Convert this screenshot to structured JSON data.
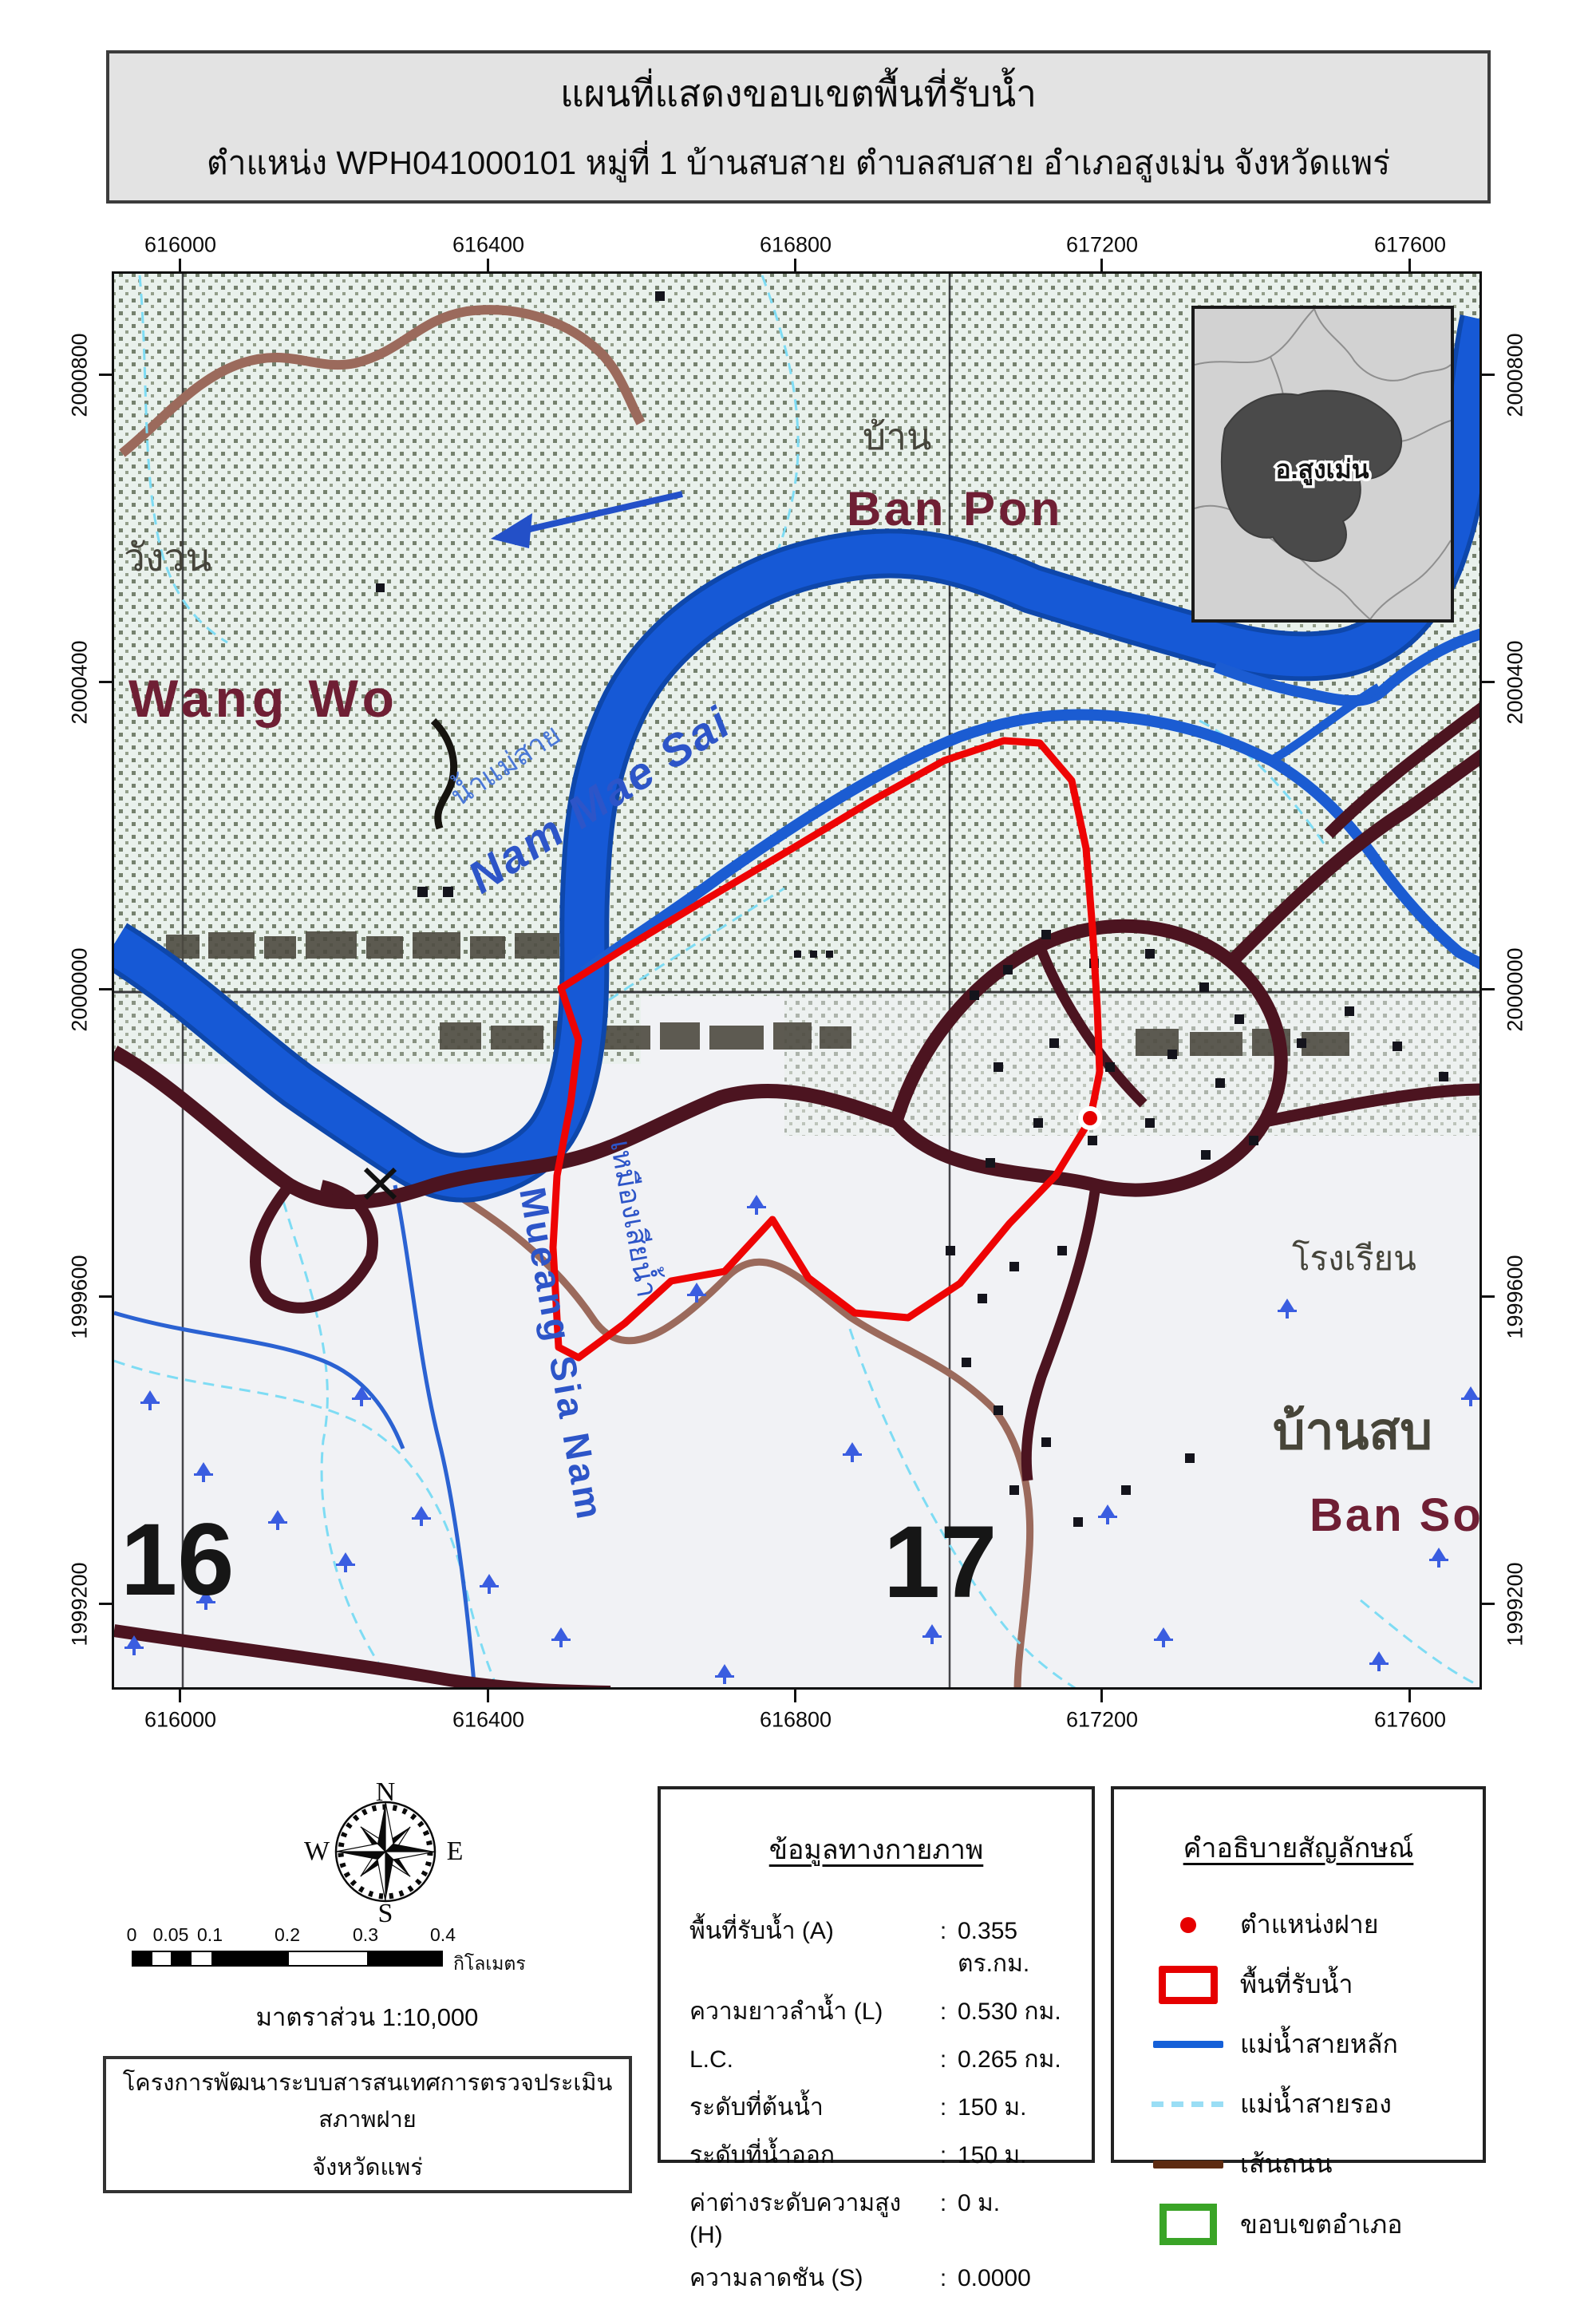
{
  "title": {
    "line1": "แผนที่แสดงขอบเขตพื้นที่รับน้ำ",
    "line2": "ตำแหน่ง WPH041000101 หมู่ที่ 1 บ้านสบสาย ตำบลสบสาย อำเภอสูงเม่น จังหวัดแพร่"
  },
  "axes": {
    "x": [
      "616000",
      "616400",
      "616800",
      "617200",
      "617600"
    ],
    "y": [
      "2000800",
      "2000400",
      "2000000",
      "1999600",
      "1999200"
    ]
  },
  "map_labels": {
    "village_nw_thai": "วังว่น",
    "village_nw_en": "Wang Wo",
    "village_ne_thai": "บ้าน",
    "village_ne_en": "Ban Pon",
    "river_thai": "น้ำแม่สาย",
    "river_en": "Nam Mae Sai",
    "canal_thai": "เหมืองเสียน้ำ",
    "canal_en": "Mueang Sia Nam",
    "grid_left": "16",
    "grid_right": "17",
    "school": "โรงเรียน",
    "village_se_thai": "บ้านสบ",
    "village_se_en": "Ban So"
  },
  "inset": {
    "district_label": "อ.สูงเม่น"
  },
  "compass": {
    "n": "N",
    "e": "E",
    "s": "S",
    "w": "W"
  },
  "scalebar": {
    "ticks": [
      "0",
      "0.05",
      "0.1",
      "0.2",
      "0.3",
      "0.4"
    ],
    "unit": "กิโลเมตร",
    "scale_text": "มาตราส่วน  1:10,000"
  },
  "info": {
    "header": "ข้อมูลทางกายภาพ",
    "colon": ":",
    "rows": [
      {
        "label": "พื้นที่รับน้ำ (A)",
        "value": "0.355 ตร.กม."
      },
      {
        "label": "ความยาวลำน้ำ (L)",
        "value": "0.530 กม."
      },
      {
        "label": "L.C.",
        "value": "0.265 กม."
      },
      {
        "label": "ระดับที่ต้นน้ำ",
        "value": "150 ม."
      },
      {
        "label": "ระดับที่น้ำออก",
        "value": "150 ม."
      },
      {
        "label": "ค่าต่างระดับความสูง (H)",
        "value": "0 ม."
      },
      {
        "label": "ความลาดชัน (S)",
        "value": "0.0000"
      }
    ]
  },
  "legend": {
    "header": "คำอธิบายสัญลักษณ์",
    "items": [
      {
        "type": "weir-point",
        "label": "ตำแหน่งฝาย"
      },
      {
        "type": "watershed-area",
        "label": "พื้นที่รับน้ำ"
      },
      {
        "type": "main-river",
        "label": "แม่น้ำสายหลัก"
      },
      {
        "type": "secondary-river",
        "label": "แม่น้ำสายรอง"
      },
      {
        "type": "road",
        "label": "เส้นถนน"
      },
      {
        "type": "district-boundary",
        "label": "ขอบเขตอำเภอ"
      }
    ]
  },
  "project": {
    "line1": "โครงการพัฒนาระบบสารสนเทศการตรวจประเมินสภาพฝาย",
    "line2": "จังหวัดแพร่"
  },
  "colors": {
    "watershed_red": "#e80b0b",
    "main_river_blue": "#1457cc",
    "secondary_river_cyan": "#8fdcf4",
    "road_brown": "#5d2b11",
    "district_green": "#3aa427",
    "map_road_maroon": "#4c1420",
    "label_maroon": "#6f1f34",
    "label_gray": "#45443a",
    "river_label_blue": "#2d55c8"
  }
}
